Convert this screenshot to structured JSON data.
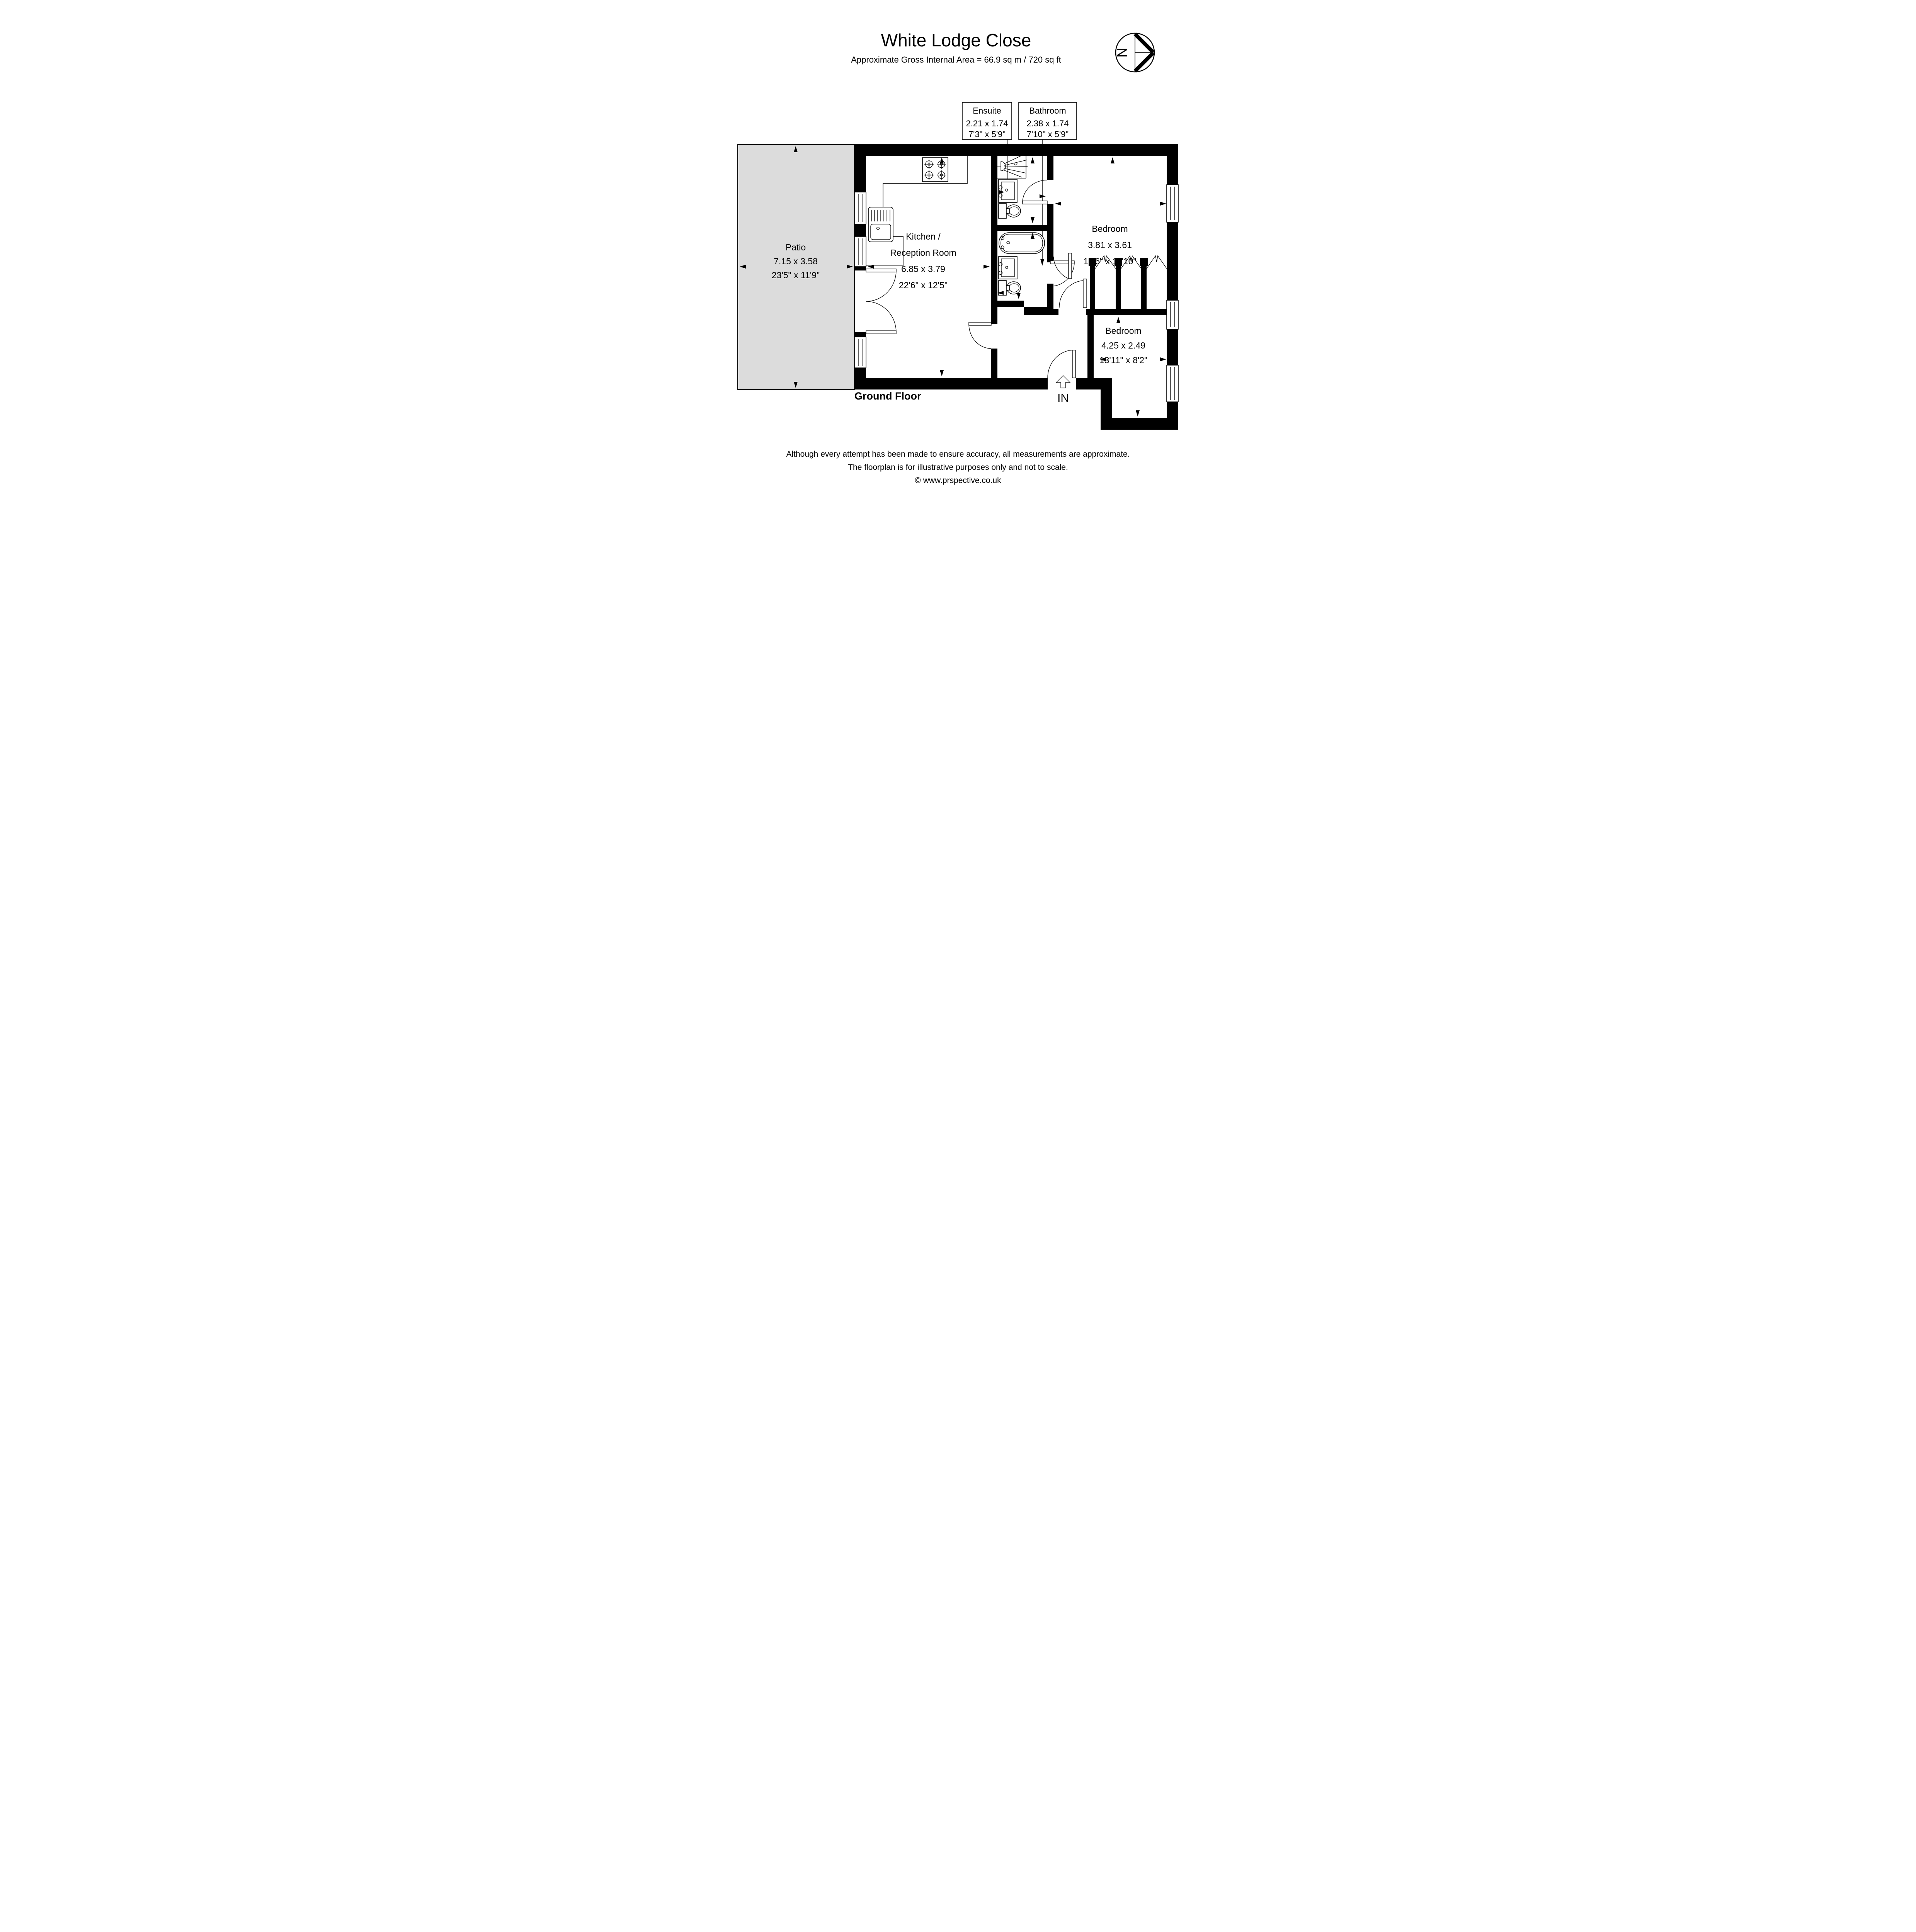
{
  "header": {
    "title": "White Lodge Close",
    "subtitle": "Approximate Gross Internal Area = 66.9 sq m / 720 sq ft"
  },
  "compass": {
    "north_label": "N"
  },
  "callouts": {
    "ensuite": {
      "name": "Ensuite",
      "metric": "2.21 x 1.74",
      "imperial": "7'3\" x 5'9\""
    },
    "bathroom": {
      "name": "Bathroom",
      "metric": "2.38 x 1.74",
      "imperial": "7'10\" x 5'9\""
    }
  },
  "rooms": {
    "patio": {
      "name": "Patio",
      "metric": "7.15 x 3.58",
      "imperial": "23'5\" x 11'9\""
    },
    "kitchen": {
      "name_line1": "Kitchen /",
      "name_line2": "Reception Room",
      "metric": "6.85 x 3.79",
      "imperial": "22'6\" x 12'5\""
    },
    "bedroom1": {
      "name": "Bedroom",
      "metric": "3.81 x 3.61",
      "imperial": "12'6\" x 11'10\""
    },
    "bedroom2": {
      "name": "Bedroom",
      "metric": "4.25 x 2.49",
      "imperial": "13'11\" x 8'2\""
    }
  },
  "labels": {
    "floor": "Ground Floor",
    "entrance": "IN"
  },
  "footer": {
    "line1": "Although every attempt has been made to ensure accuracy, all measurements are approximate.",
    "line2": "The floorplan is for illustrative purposes only and not to scale.",
    "copyright": "© www.prspective.co.uk"
  },
  "colors": {
    "wall": "#000000",
    "patio_fill": "#dcdcdc",
    "background": "#ffffff"
  }
}
